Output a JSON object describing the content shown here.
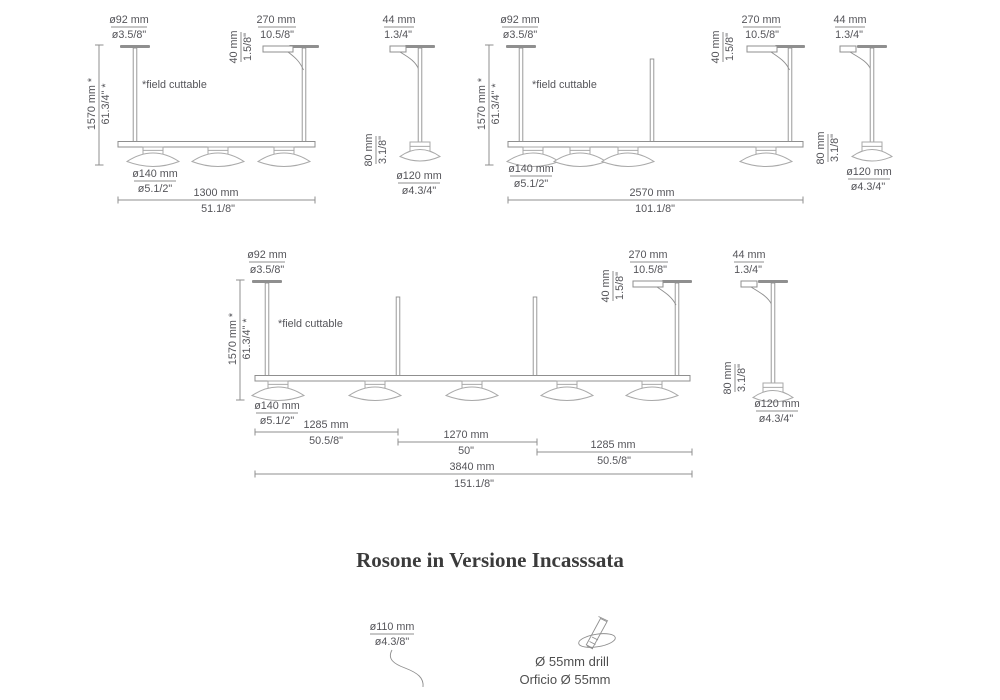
{
  "page": {
    "title": "Rosone in Versione Incasssata"
  },
  "annotations": {
    "field_cuttable": "*field cuttable"
  },
  "dims": {
    "canopy92": {
      "mm": "ø92 mm",
      "inch": "ø3.5/8\""
    },
    "track270": {
      "mm": "270 mm",
      "inch": "10.5/8\""
    },
    "track40": {
      "mm": "40 mm",
      "inch": "1.5/8\""
    },
    "drop1570": {
      "mm": "1570 mm *",
      "inch": "61.3/4\" *"
    },
    "shade140": {
      "mm": "ø140 mm",
      "inch": "ø5.1/2\""
    },
    "canopy44": {
      "mm": "44 mm",
      "inch": "1.3/4\""
    },
    "drop80": {
      "mm": "80 mm",
      "inch": "3.1/8\""
    },
    "shade120": {
      "mm": "ø120 mm",
      "inch": "ø4.3/4\""
    },
    "len1300": {
      "mm": "1300 mm",
      "inch": "51.1/8\""
    },
    "len2570": {
      "mm": "2570 mm",
      "inch": "101.1/8\""
    },
    "len1285": {
      "mm": "1285 mm",
      "inch": "50.5/8\""
    },
    "len1270": {
      "mm": "1270 mm",
      "inch": "50\""
    },
    "len3840": {
      "mm": "3840 mm",
      "inch": "151.1/8\""
    },
    "rosone110": {
      "mm": "ø110 mm",
      "inch": "ø4.3/8\""
    }
  },
  "rosone": {
    "drill_en": "Ø 55mm drill",
    "drill_it": "Orficio Ø 55mm"
  },
  "colors": {
    "line": "#8f8f8f",
    "shade_line": "#a9a9a9",
    "text": "#55555a",
    "title": "#3b3b3b"
  }
}
